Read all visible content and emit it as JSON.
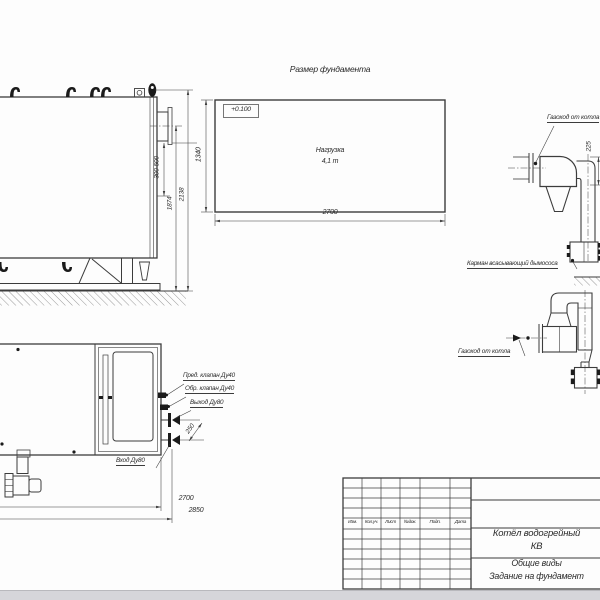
{
  "drawing": {
    "side_view": {
      "dim_nozzle_range": "300-500",
      "dim_height_axis": "1874",
      "dim_total_height": "2138"
    },
    "foundation_plan": {
      "title": "Размер фундамента",
      "level_mark": "+0.100",
      "load_label": "Нагрузка",
      "load_value": "4,1 т",
      "dim_width": "2700",
      "dim_depth": "1340"
    },
    "flue_top": {
      "duct_label": "Газоход от котла",
      "pocket_label": "Карман всасывающий дымососа",
      "dim_height": "225"
    },
    "flue_bottom": {
      "duct_label": "Газоход от котла"
    },
    "plan_view": {
      "safety_valve_label": "Пред. клапан Ду40",
      "check_valve_label": "Обр. клапан Ду40",
      "outlet_label": "Выход Ду80",
      "inlet_label": "Вход Ду80",
      "dim_nozzle_spacing": "250",
      "dim_length_body": "2700",
      "dim_length_total": "2850"
    },
    "title_block": {
      "columns": [
        "Изм.",
        "Кол.уч.",
        "Лист",
        "№док.",
        "Подп.",
        "Дата"
      ],
      "product_line1": "Котёл водогрейный",
      "product_line2": "КВ",
      "doc_line1": "Общие виды",
      "doc_line2": "Задание на фундамент"
    }
  }
}
